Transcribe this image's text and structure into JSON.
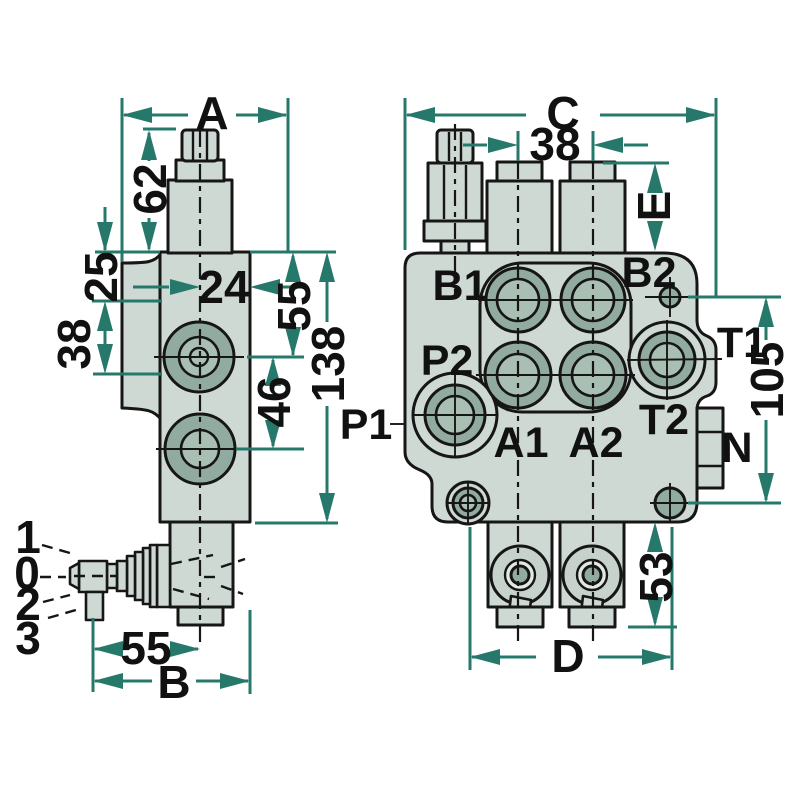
{
  "colors": {
    "dimension_teal": "#26796a",
    "body_fill": "#cfd9d3",
    "boss_fill": "#92aba0",
    "boss_inner_fill": "#a9bfb4",
    "line_black": "#161616",
    "background": "#ffffff"
  },
  "left_view": {
    "dims": {
      "overall_width": "A",
      "relief_height": "62",
      "offset_25": "25",
      "offset_38": "38",
      "offset_24": "24",
      "port1_depth": "55",
      "overall_height": "138",
      "port_spacing": "46",
      "lever_offset": "55",
      "overall_depth": "B"
    },
    "lever_positions": {
      "pos_1": "1",
      "pos_0": "0",
      "pos_2": "2",
      "pos_3": "3"
    }
  },
  "right_view": {
    "dims": {
      "overall_width": "C",
      "spool_spacing": "38",
      "cap_height": "E",
      "mount_height": "105",
      "spool_end_height": "53",
      "mount_spacing": "D"
    },
    "port_labels": {
      "b1": "B1",
      "b2": "B2",
      "p1": "P1",
      "p2": "P2",
      "a1": "A1",
      "a2": "A2",
      "t1": "T1",
      "t2": "T2",
      "n": "N"
    }
  }
}
